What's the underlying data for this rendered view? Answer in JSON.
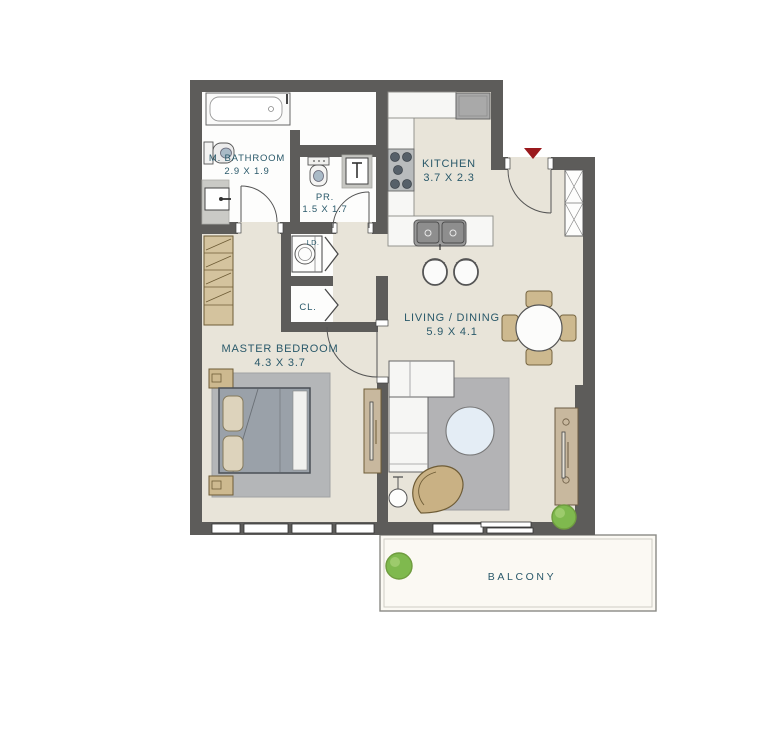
{
  "plan": {
    "rooms": {
      "master_bathroom": {
        "name": "M. BATHROOM",
        "dimensions": "2.9 X 1.9"
      },
      "powder_room": {
        "name": "PR.",
        "dimensions": "1.5 X 1.7"
      },
      "kitchen": {
        "name": "KITCHEN",
        "dimensions": "3.7 X 2.3"
      },
      "living_dining": {
        "name": "LIVING / DINING",
        "dimensions": "5.9 X 4.1"
      },
      "master_bedroom": {
        "name": "MASTER BEDROOM",
        "dimensions": "4.3 X 3.7"
      },
      "closet": {
        "name": "CL."
      },
      "laundry": {
        "name": "LD."
      },
      "balcony": {
        "name": "BALCONY"
      }
    },
    "colors": {
      "wall": "#5d5c5a",
      "floor": "#e8e4d9",
      "wet_floor": "#fdfdfc",
      "balcony_floor": "#fbf9f3",
      "label_text": "#2a596a",
      "entry_marker": "#9a191d",
      "plant": "#7fb94e",
      "wood_furniture": "#cdb98f",
      "rug": "#b3b3b5"
    },
    "fixtures": [
      "bathtub-icon",
      "toilet-icon",
      "washbasin-icon",
      "washing-machine-icon",
      "stove-icon",
      "refrigerator-icon",
      "kitchen-sink-icon",
      "bar-stool-icon",
      "dining-table-icon",
      "dining-chair-icon",
      "sofa-icon",
      "coffee-table-icon",
      "floor-lamp-icon",
      "armchair-icon",
      "tv-console-icon",
      "wardrobe-icon",
      "bed-icon",
      "nightstand-icon",
      "plant-icon",
      "entry-arrow-icon",
      "duct-shaft-icon"
    ]
  }
}
